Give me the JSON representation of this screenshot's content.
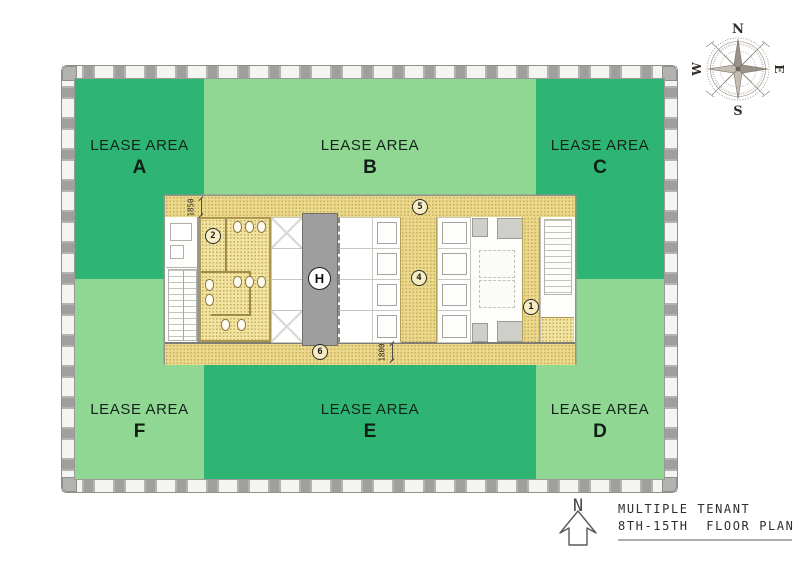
{
  "colors": {
    "dark_green": "#2fb573",
    "light_green": "#8fd792",
    "corridor_yellow": "#ecd88a",
    "room_yellow": "#f2e4a0",
    "shaft_gray": "#9e9e9e"
  },
  "lease_areas": [
    {
      "title": "LEASE AREA",
      "letter": "A",
      "shade": "dark"
    },
    {
      "title": "LEASE AREA",
      "letter": "B",
      "shade": "light"
    },
    {
      "title": "LEASE AREA",
      "letter": "C",
      "shade": "dark"
    },
    {
      "title": "LEASE AREA",
      "letter": "F",
      "shade": "light"
    },
    {
      "title": "LEASE AREA",
      "letter": "E",
      "shade": "dark"
    },
    {
      "title": "LEASE AREA",
      "letter": "D",
      "shade": "light"
    }
  ],
  "core": {
    "markers": {
      "m1": "1",
      "m2": "2",
      "m4": "4",
      "m5": "5",
      "m6": "6"
    },
    "shaft_label": "H",
    "dimensions": {
      "north_corridor": "1850",
      "south_corridor": "1800"
    }
  },
  "compass": {
    "north": "N",
    "east": "E",
    "south": "S",
    "west": "W"
  },
  "legend": {
    "north_arrow_label": "N",
    "title_line1": "MULTIPLE TENANT",
    "title_line2": "8TH-15TH  FLOOR PLAN"
  }
}
